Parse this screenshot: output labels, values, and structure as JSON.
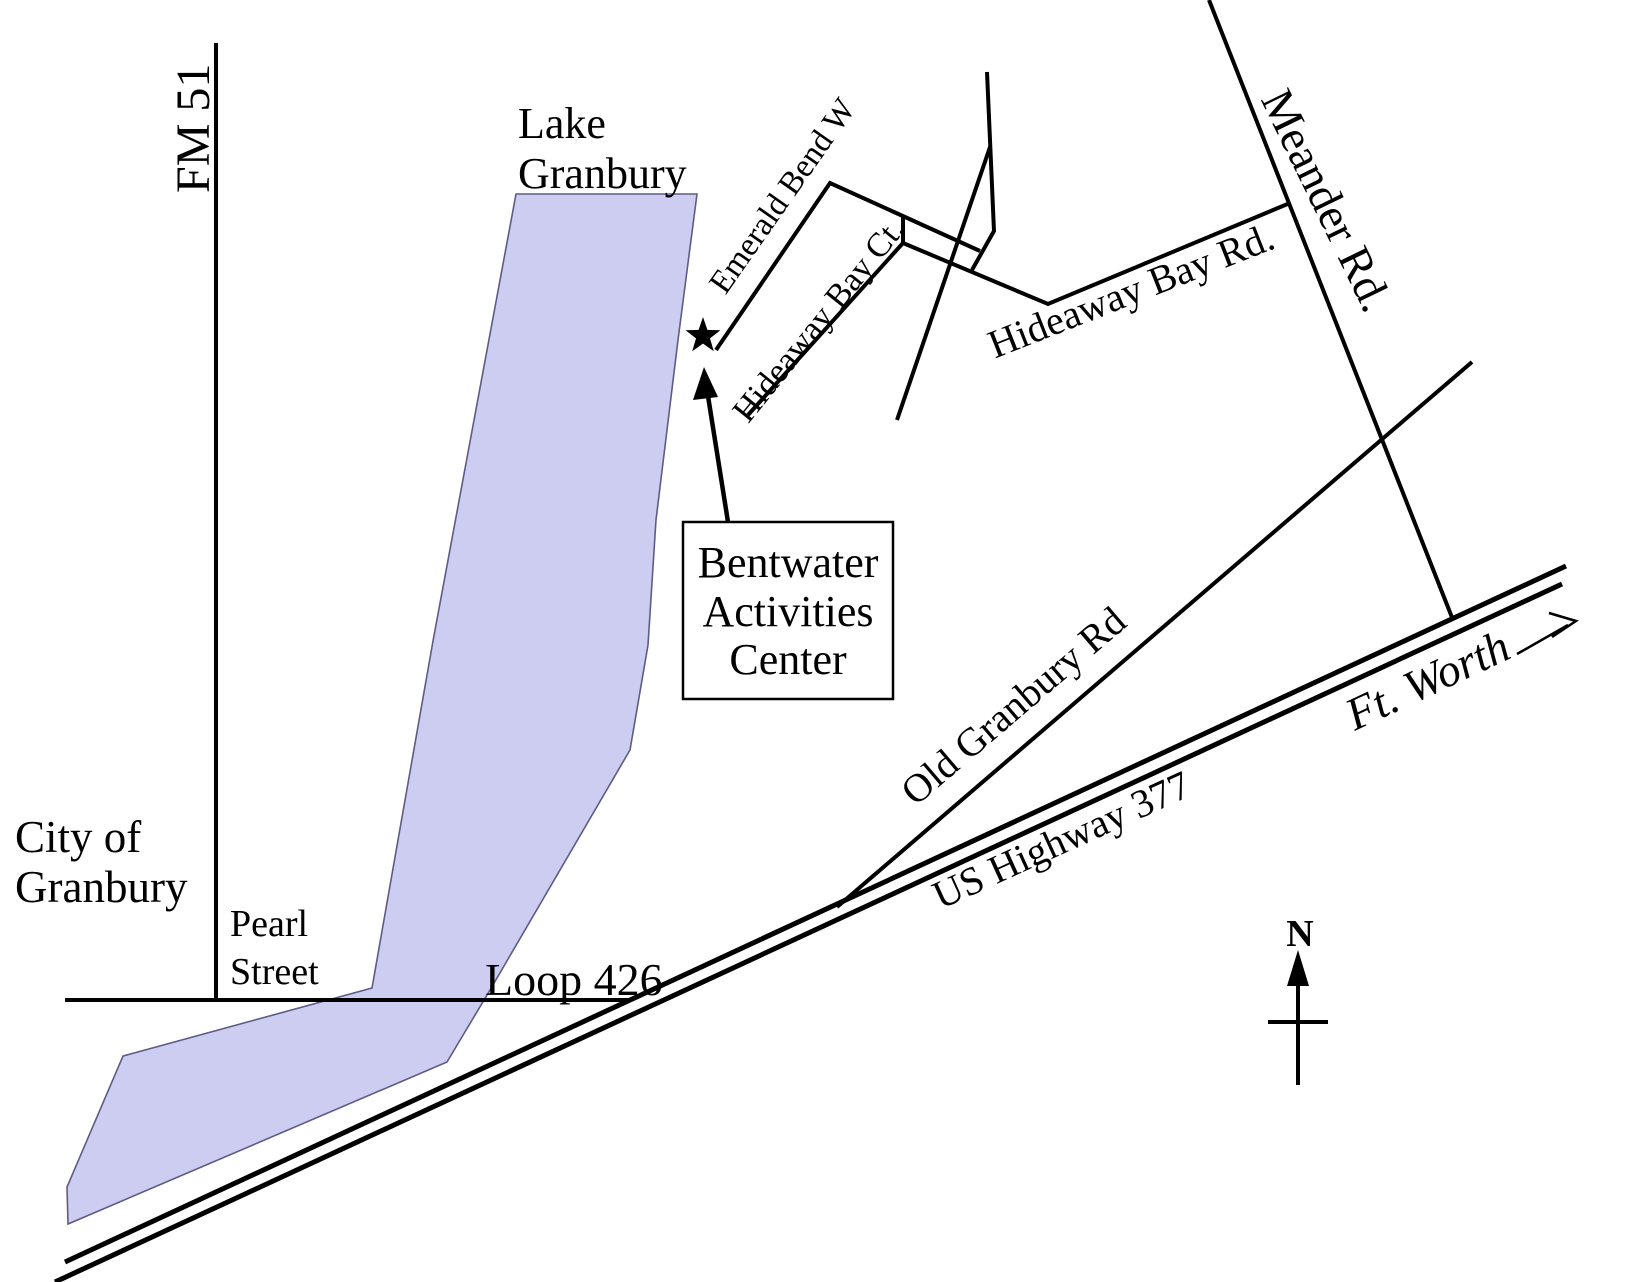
{
  "map": {
    "labels": {
      "fm51": "FM 51",
      "lake_line1": "Lake",
      "lake_line2": "Granbury",
      "emerald_bend": "Emerald Bend W",
      "hideaway_ct": "Hideaway Bay Ct.",
      "hideaway_rd": "Hideaway Bay Rd.",
      "meander": "Meander Rd.",
      "old_granbury": "Old Granbury Rd",
      "us_377": "US Highway 377",
      "ft_worth": "Ft. Worth",
      "city_line1": "City of",
      "city_line2": "Granbury",
      "pearl_line1": "Pearl",
      "pearl_line2": "Street",
      "loop426": "Loop 426",
      "compass_n": "N"
    },
    "callout": {
      "line1": "Bentwater",
      "line2": "Activities",
      "line3": "Center"
    },
    "colors": {
      "lake_fill": "#cdcdf2",
      "lake_stroke": "#5c5c86",
      "line": "#000000"
    }
  }
}
